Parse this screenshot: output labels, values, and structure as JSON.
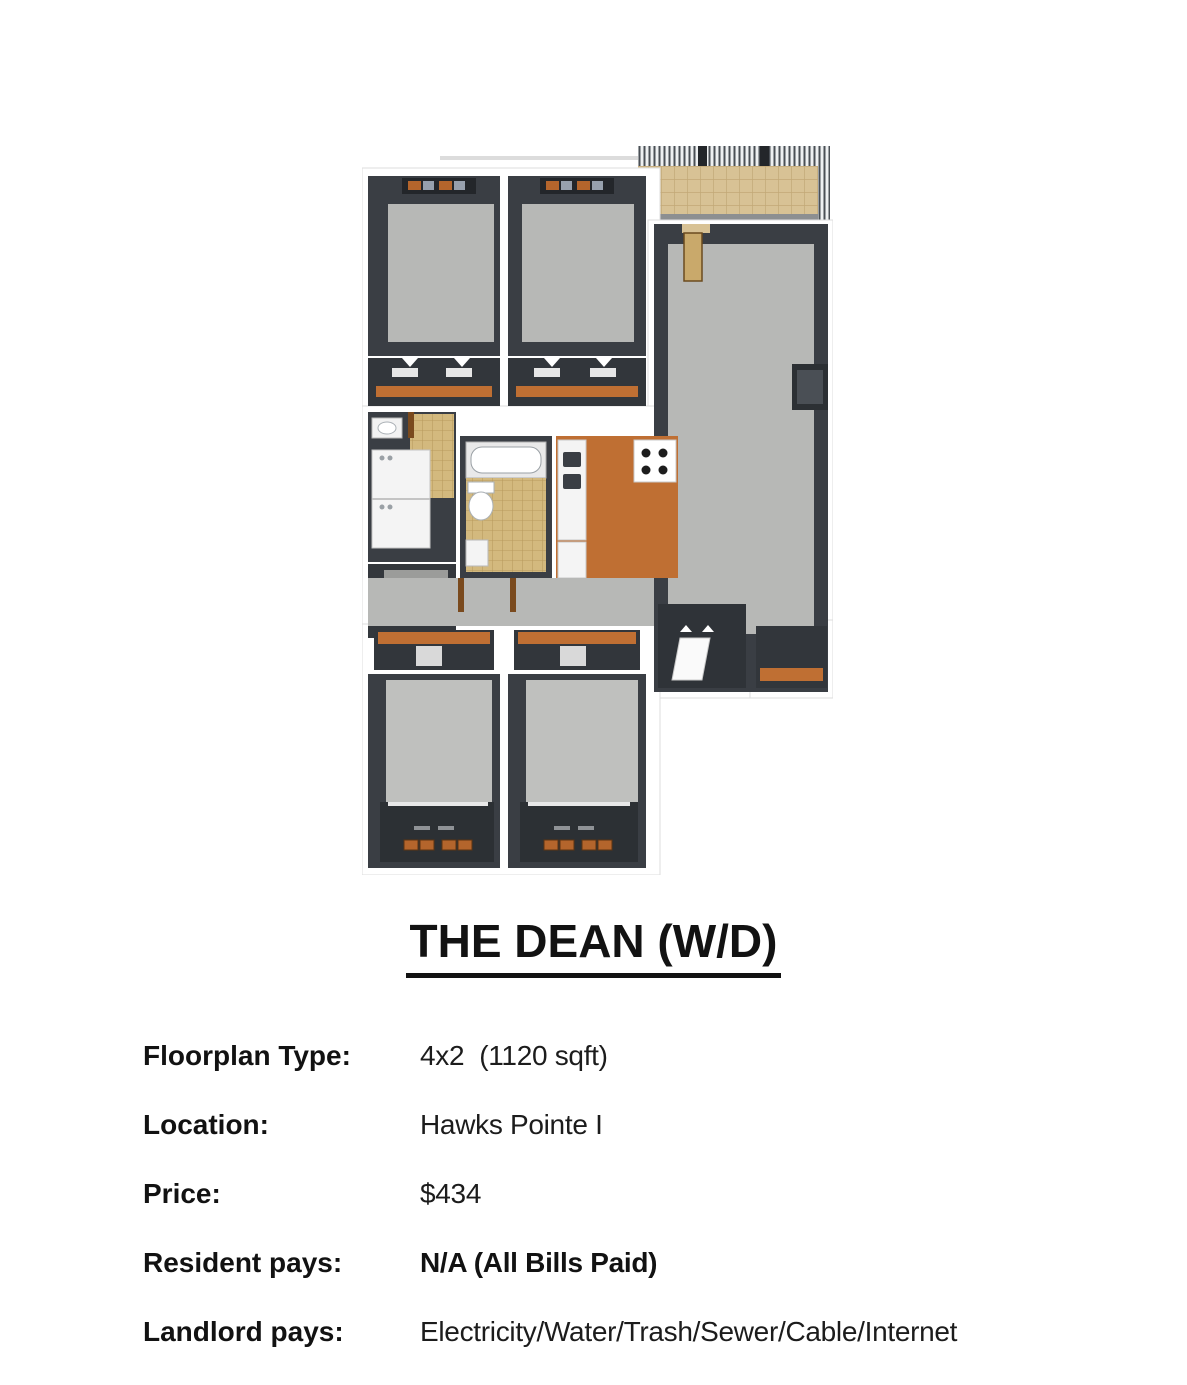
{
  "page": {
    "title": "THE DEAN (W/D)"
  },
  "specs": {
    "rows": [
      {
        "label": "Floorplan Type:",
        "value": "4x2  (1120 sqft)"
      },
      {
        "label": "Location:",
        "value": "Hawks Pointe I"
      },
      {
        "label": "Price:",
        "value": "$434"
      },
      {
        "label": "Resident pays:",
        "value": "N/A (All Bills Paid)"
      },
      {
        "label": "Landlord pays:",
        "value": "Electricity/Water/Trash/Sewer/Cable/Internet"
      }
    ]
  },
  "floorplan": {
    "alt": "3D rendered floor plan: four bedrooms, two baths, kitchen, living room, laundry, balcony",
    "colors": {
      "wall_dark": "#3a3e44",
      "wall_darker": "#2c3034",
      "carpet": "#b7b8b6",
      "kitchen_floor": "#bf6f33",
      "bath_tile": "#d3b97e",
      "balcony_tile": "#d8c295",
      "shelf_orange": "#bf6f33",
      "pillow_orange": "#b4652c",
      "appliance_white": "#f4f4f4"
    }
  }
}
